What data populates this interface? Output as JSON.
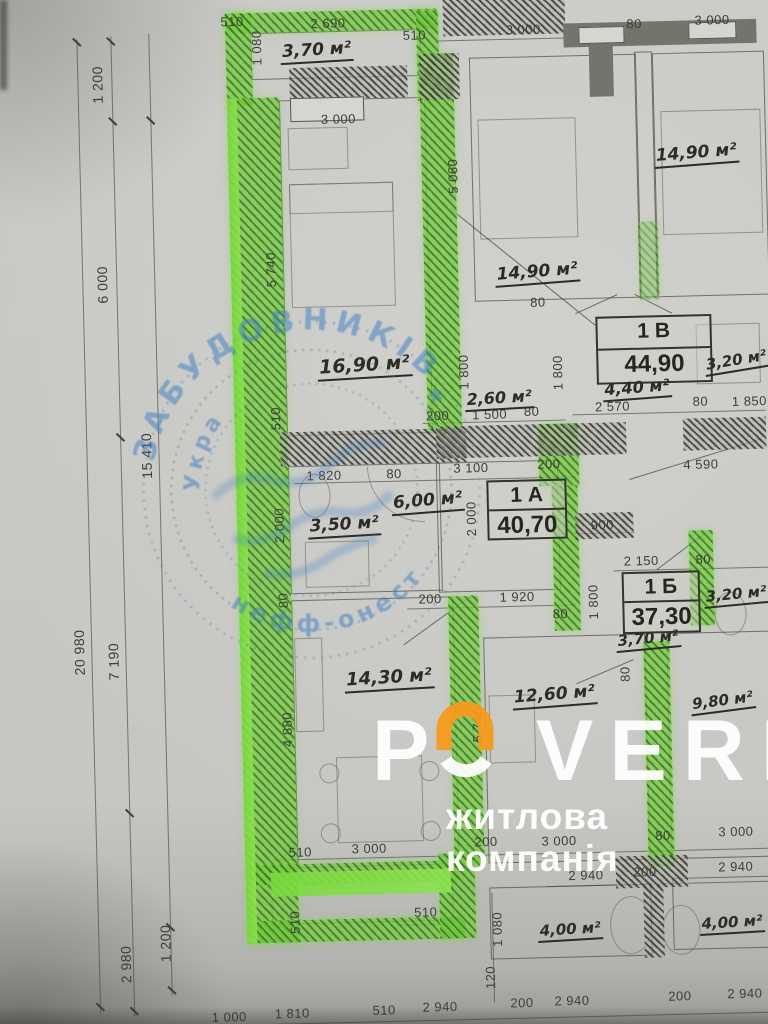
{
  "watermark": {
    "p": "P",
    "verh": "VERH",
    "tagline": "житлова компанія",
    "logo_color": "#f59a1e"
  },
  "stamp": {
    "arc_top": "ЗАБУДОВНИКІВ",
    "arc_bottom": "нефф-онест",
    "arc_inner": "Укра",
    "star": "*"
  },
  "apartment_tags": [
    {
      "id": "1 А",
      "area": "40,70"
    },
    {
      "id": "1 Б",
      "area": "37,30"
    },
    {
      "id": "1 В",
      "area": "44,90"
    }
  ],
  "room_labels": [
    {
      "t": "3,70 м²",
      "x": 328,
      "y": 50,
      "r": -2,
      "s": 17
    },
    {
      "t": "14,90 м²",
      "x": 705,
      "y": 162,
      "r": -3,
      "s": 17
    },
    {
      "t": "14,90 м²",
      "x": 543,
      "y": 277,
      "r": -3,
      "s": 17
    },
    {
      "t": "16,90 м²",
      "x": 368,
      "y": 366,
      "r": -2,
      "s": 19
    },
    {
      "t": "2,60 м²",
      "x": 502,
      "y": 402,
      "r": -2,
      "s": 16
    },
    {
      "t": "4,40 м²",
      "x": 640,
      "y": 395,
      "r": -3,
      "s": 16
    },
    {
      "t": "3,20 м²",
      "x": 740,
      "y": 370,
      "r": -8,
      "s": 15
    },
    {
      "t": "6,00 м²",
      "x": 428,
      "y": 503,
      "r": -3,
      "s": 17
    },
    {
      "t": "3,50 м²",
      "x": 344,
      "y": 525,
      "r": -2,
      "s": 17
    },
    {
      "t": "3,20 м²",
      "x": 734,
      "y": 604,
      "r": -4,
      "s": 15
    },
    {
      "t": "3,70 м²",
      "x": 645,
      "y": 646,
      "r": -4,
      "s": 15
    },
    {
      "t": "14,30 м²",
      "x": 385,
      "y": 679,
      "r": -2,
      "s": 18
    },
    {
      "t": "12,60 м²",
      "x": 550,
      "y": 700,
      "r": -3,
      "s": 17
    },
    {
      "t": "9,80 м²",
      "x": 718,
      "y": 710,
      "r": -6,
      "s": 15
    },
    {
      "t": "4,00 м²",
      "x": 560,
      "y": 935,
      "r": -2,
      "s": 15
    },
    {
      "t": "4,00 м²",
      "x": 722,
      "y": 932,
      "r": -2,
      "s": 15
    }
  ],
  "dim_labels": [
    {
      "t": "510",
      "x": 244,
      "y": 18
    },
    {
      "t": "2 690",
      "x": 340,
      "y": 22
    },
    {
      "t": "1 080",
      "x": 268,
      "y": 45,
      "r": -90
    },
    {
      "t": "3 000",
      "x": 348,
      "y": 118
    },
    {
      "t": "510",
      "x": 426,
      "y": 36
    },
    {
      "t": "3 000",
      "x": 535,
      "y": 33
    },
    {
      "t": "80",
      "x": 646,
      "y": 30
    },
    {
      "t": "3 000",
      "x": 724,
      "y": 28
    },
    {
      "t": "5 060",
      "x": 461,
      "y": 178,
      "r": -90
    },
    {
      "t": "5 740",
      "x": 277,
      "y": 267,
      "r": -90
    },
    {
      "t": "510",
      "x": 278,
      "y": 416,
      "r": -90
    },
    {
      "t": "1 800",
      "x": 467,
      "y": 374,
      "r": -90
    },
    {
      "t": "1 800",
      "x": 561,
      "y": 377,
      "r": -90
    },
    {
      "t": "80",
      "x": 543,
      "y": 306
    },
    {
      "t": "200",
      "x": 440,
      "y": 417
    },
    {
      "t": "1 500",
      "x": 492,
      "y": 417
    },
    {
      "t": "80",
      "x": 534,
      "y": 415
    },
    {
      "t": "2 570",
      "x": 615,
      "y": 412
    },
    {
      "t": "80",
      "x": 703,
      "y": 409
    },
    {
      "t": "1 850",
      "x": 752,
      "y": 410
    },
    {
      "t": "4 590",
      "x": 702,
      "y": 472
    },
    {
      "t": "1 820",
      "x": 325,
      "y": 474
    },
    {
      "t": "80",
      "x": 395,
      "y": 474
    },
    {
      "t": "3 100",
      "x": 472,
      "y": 470
    },
    {
      "t": "200",
      "x": 550,
      "y": 468
    },
    {
      "t": "2 000",
      "x": 279,
      "y": 523,
      "r": -90
    },
    {
      "t": "2 000",
      "x": 471,
      "y": 521,
      "r": -90
    },
    {
      "t": "900",
      "x": 602,
      "y": 530
    },
    {
      "t": "2 150",
      "x": 640,
      "y": 567
    },
    {
      "t": "80",
      "x": 702,
      "y": 567
    },
    {
      "t": "1 800",
      "x": 591,
      "y": 607,
      "r": -90
    },
    {
      "t": "80",
      "x": 281,
      "y": 598,
      "r": -90
    },
    {
      "t": "200",
      "x": 428,
      "y": 600
    },
    {
      "t": "1 920",
      "x": 515,
      "y": 600
    },
    {
      "t": "80",
      "x": 558,
      "y": 618
    },
    {
      "t": "4 880",
      "x": 282,
      "y": 727,
      "r": -90
    },
    {
      "t": "5 740",
      "x": 472,
      "y": 727,
      "r": -90
    },
    {
      "t": "80",
      "x": 621,
      "y": 680,
      "r": -90
    },
    {
      "t": "510",
      "x": 292,
      "y": 850
    },
    {
      "t": "3 000",
      "x": 361,
      "y": 848
    },
    {
      "t": "200",
      "x": 478,
      "y": 844
    },
    {
      "t": "3 000",
      "x": 551,
      "y": 845
    },
    {
      "t": "80",
      "x": 655,
      "y": 842
    },
    {
      "t": "3 000",
      "x": 728,
      "y": 840
    },
    {
      "t": "510",
      "x": 285,
      "y": 920,
      "r": -90
    },
    {
      "t": "510",
      "x": 416,
      "y": 913
    },
    {
      "t": "1 080",
      "x": 487,
      "y": 932,
      "r": -90
    },
    {
      "t": "120",
      "x": 479,
      "y": 980,
      "r": -90
    },
    {
      "t": "2 940",
      "x": 577,
      "y": 880
    },
    {
      "t": "200",
      "x": 636,
      "y": 878
    },
    {
      "t": "2 940",
      "x": 727,
      "y": 875
    },
    {
      "t": "1 000",
      "x": 217,
      "y": 1013
    },
    {
      "t": "1 810",
      "x": 280,
      "y": 1011
    },
    {
      "t": "510",
      "x": 372,
      "y": 1010
    },
    {
      "t": "2 940",
      "x": 428,
      "y": 1008
    },
    {
      "t": "200",
      "x": 510,
      "y": 1006
    },
    {
      "t": "2 940",
      "x": 560,
      "y": 1005
    },
    {
      "t": "200",
      "x": 668,
      "y": 1003
    },
    {
      "t": "2 940",
      "x": 733,
      "y": 1002
    }
  ],
  "left_dim_labels": [
    {
      "t": "1 200",
      "x": 108,
      "y": 78,
      "r": -90
    },
    {
      "t": "6 000",
      "x": 108,
      "y": 278,
      "r": -90
    },
    {
      "t": "15 410",
      "x": 148,
      "y": 450,
      "r": -90
    },
    {
      "t": "20 980",
      "x": 76,
      "y": 645,
      "r": -90
    },
    {
      "t": "7 190",
      "x": 110,
      "y": 655,
      "r": -90
    },
    {
      "t": "2 980",
      "x": 115,
      "y": 958,
      "r": -90
    },
    {
      "t": "1 200",
      "x": 155,
      "y": 938,
      "r": -90
    }
  ]
}
